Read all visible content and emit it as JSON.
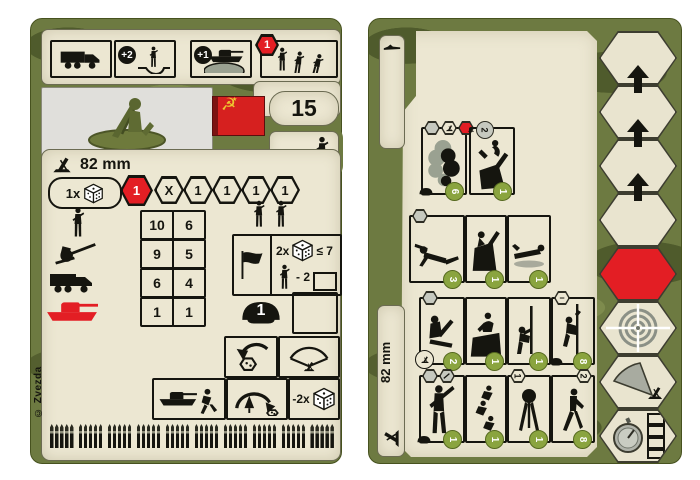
{
  "colors": {
    "accent_red": "#e31e24",
    "olive": "#6d7a41",
    "olive_dark": "#4f5b2c",
    "cream": "#ece7d2",
    "green_cost_badge": "#8aa43f",
    "flag_red": "#d6201f",
    "flag_gold": "#edc531"
  },
  "left_card": {
    "product_code": "6109",
    "points": "15",
    "caliber": "82 mm",
    "copyright": "© Zvezda",
    "flag": {
      "star": "★",
      "hammer_sickle": "☭"
    },
    "header_icons": [
      {
        "name": "truck"
      },
      {
        "name": "soldier-in-trench",
        "badge": "+2"
      },
      {
        "name": "tank-behind-hill",
        "badge": "+1"
      },
      {
        "name": "advancing-soldiers",
        "hex_value": "1"
      }
    ],
    "hex_row": {
      "prefix": "1x",
      "cells": [
        "1",
        "X",
        "1",
        "1",
        "1",
        "1"
      ]
    },
    "combat_table": [
      {
        "target": "infantry",
        "v1": "10",
        "v2": "6"
      },
      {
        "target": "gun",
        "v1": "9",
        "v2": "5"
      },
      {
        "target": "truck",
        "v1": "6",
        "v2": "4"
      },
      {
        "target": "tank",
        "v1": "1",
        "v2": "1"
      }
    ],
    "morale_box": {
      "dice_count": "2x",
      "threshold": "≤ 7",
      "penalty": "- 2"
    },
    "armor_value": "1",
    "ammo_dice_penalty": "-2x",
    "ammo_track": {
      "groups": 10,
      "rounds_per_group": 5
    }
  },
  "right_card": {
    "caliber": "82 mm",
    "tab_icon": "prone-soldier",
    "action_rows": [
      {
        "boxes": [
          {
            "name": "smoke-screen",
            "cost": "6"
          },
          {
            "name": "mortar-strike",
            "badge": "2",
            "cost": "1"
          }
        ]
      },
      {
        "boxes": [
          {
            "name": "crawl",
            "cost": "3"
          },
          {
            "name": "fire-from-position",
            "cost": "1"
          },
          {
            "name": "go-prone",
            "cost": "1"
          }
        ]
      },
      {
        "boxes": [
          {
            "name": "deploy-mortar",
            "cost": "2"
          },
          {
            "name": "climb-obstacle",
            "cost": "1"
          },
          {
            "name": "signal-pole",
            "cost": "1"
          },
          {
            "name": "climb-rope",
            "badge": "−",
            "cost": "8"
          }
        ]
      },
      {
        "boxes": [
          {
            "name": "stand-and-fire",
            "cost": "1"
          },
          {
            "name": "run",
            "cost": "1"
          },
          {
            "name": "pack-mortar",
            "badge": "1",
            "cost": "1"
          },
          {
            "name": "march",
            "badge": "2",
            "cost": "8"
          }
        ]
      }
    ],
    "order_column": {
      "plain_hexes": 4,
      "arrows": 3,
      "special_hexes": [
        "red",
        "target",
        "firing-arc",
        "stopwatch"
      ]
    }
  }
}
